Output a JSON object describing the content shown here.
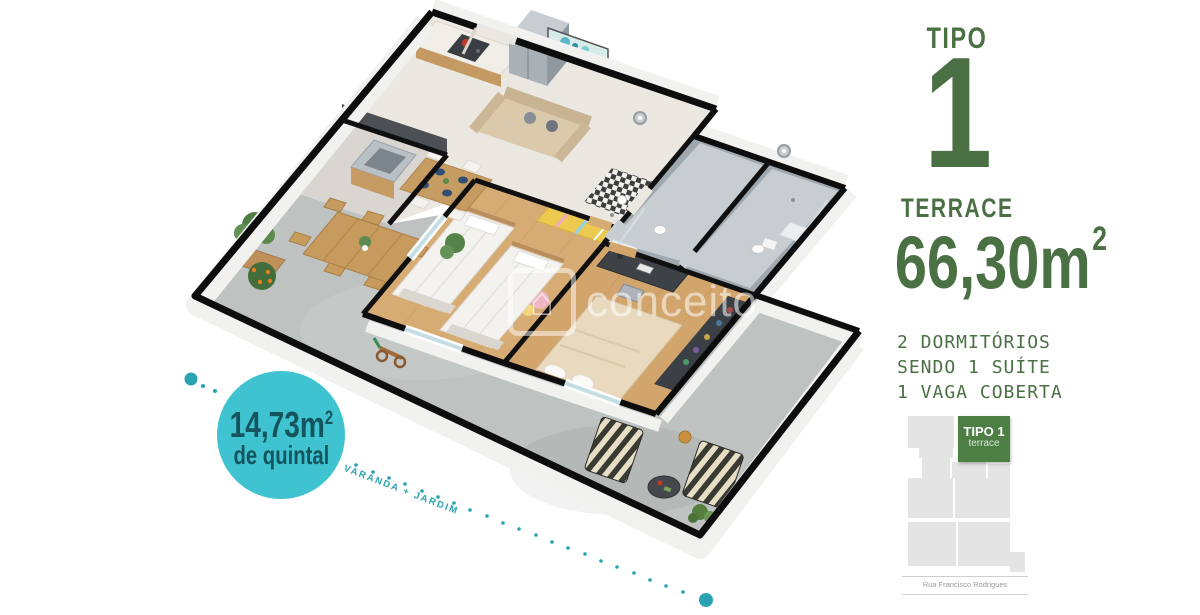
{
  "colors": {
    "accent_green": "#4a7044",
    "siteplan_green": "#4d7f45",
    "badge_teal": "#3fc3d1",
    "badge_text_teal": "#14545d",
    "dotted_trail_teal": "#2aa3b1",
    "wall_black": "#0d0d0d",
    "wood_floor": "#d7ac74",
    "terrace_concrete": "#bec2c1"
  },
  "badge": {
    "area_value": "14,73m",
    "area_sup": "2",
    "caption": "de quintal"
  },
  "terrace_trail": {
    "label": "VARANDA + JARDIM"
  },
  "watermark": {
    "text": "conceito",
    "logo": "house-icon"
  },
  "panel": {
    "type_label": "TIPO",
    "type_number": "1",
    "type_name": "TERRACE",
    "area_value": "66,30m",
    "area_sup": "2",
    "features": [
      "2 DORMITÓRIOS",
      "SENDO 1 SUÍTE",
      "1 VAGA COBERTA"
    ]
  },
  "siteplan": {
    "unit_label": "TIPO 1",
    "unit_sublabel": "terrace",
    "street_name": "Rua Francisco Rodrigues"
  }
}
